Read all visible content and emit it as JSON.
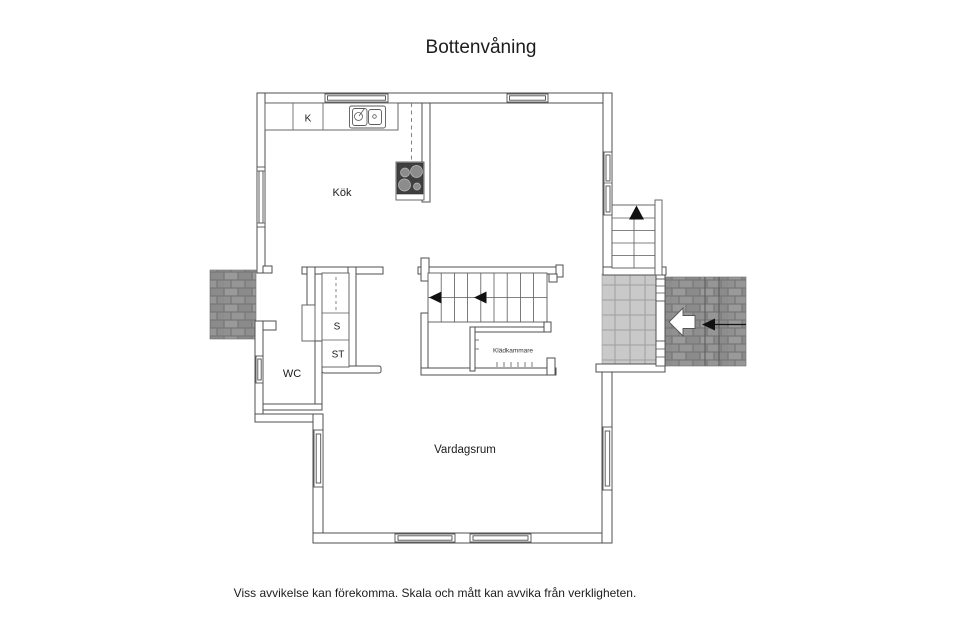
{
  "title": "Bottenvåning",
  "disclaimer": "Viss avvikelse kan förekomma. Skala och mått kan avvika från verkligheten.",
  "rooms": {
    "kitchen": {
      "label": "Kök"
    },
    "fridge_unit": {
      "label": "K"
    },
    "wc": {
      "label": "WC"
    },
    "closet_s": {
      "label": "S"
    },
    "closet_st": {
      "label": "ST"
    },
    "kladkammare": {
      "label": "Klädkammare"
    },
    "livingroom": {
      "label": "Vardagsrum"
    }
  },
  "colors": {
    "wall_stroke": "#4f4f4f",
    "brick_dark": "#8f8f8f",
    "tile_light": "#cacaca",
    "stove": "#3f3f3f",
    "arrow_black": "#111111",
    "arrow_white": "#ffffff"
  }
}
